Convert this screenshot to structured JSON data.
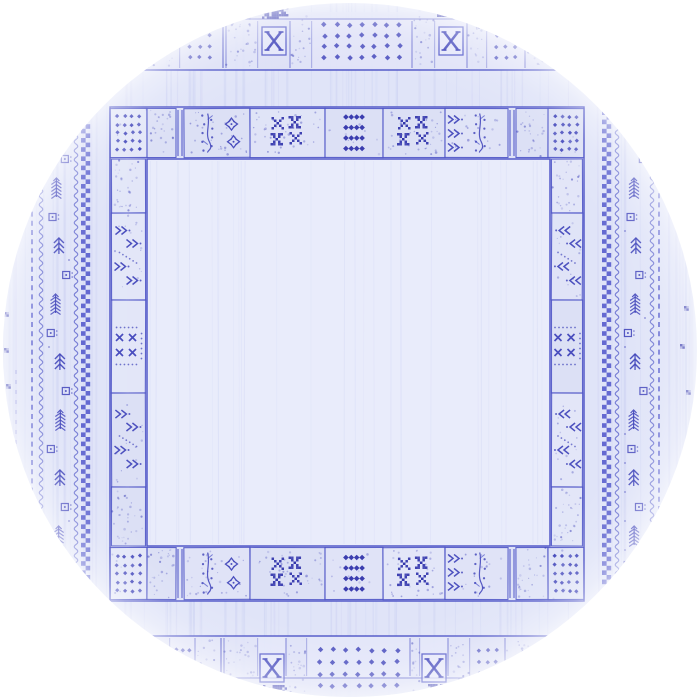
{
  "image": {
    "kind": "top-view photo of a round area rug",
    "style": "blue tribal gabbeh rug with patchwork panel borders on a pale periwinkle field",
    "page_background": "#ffffff"
  },
  "palette": {
    "base": "#e0e4f8",
    "band": "#dee2f7",
    "panel_light": "#e4e7f9",
    "panel_mid": "#e1e4f8",
    "panel_deep": "#dce0f5",
    "field": "#e9ecfb",
    "ink": "#3c40b8",
    "dark": "#3134ab",
    "line": "#4c52c6",
    "checker": "#4d54ca",
    "dash": "#5a60cf",
    "texture": "#7b86e0",
    "field_texture": "#98a2e6",
    "rim": "#ffffff"
  },
  "geometry": {
    "canvas": 700,
    "circle": {
      "cx": 350,
      "cy": 350,
      "r": 347
    },
    "ring": {
      "outer": {
        "x": 110,
        "y": 107,
        "x2": 584,
        "y2": 601
      },
      "inner": {
        "x": 147,
        "y": 159,
        "x2": 550,
        "y2": 546
      }
    },
    "outer_band_top": {
      "bg_y": 12,
      "inner_line_y": 19,
      "edge_line_y": 70
    },
    "outer_band_bottom": {
      "bg_y2": 700,
      "inner_line_y": 678,
      "edge_line_y": 636
    }
  },
  "main_border": {
    "top_panels": [
      {
        "x": 110,
        "w": 37,
        "m": "dotsGrid"
      },
      {
        "x": 147,
        "w": 29,
        "m": "speckle"
      },
      {
        "x": 176,
        "w": 8,
        "m": "divider2"
      },
      {
        "x": 184,
        "w": 66,
        "m": "treeSnow"
      },
      {
        "x": 250,
        "w": 75,
        "m": "xxChecker"
      },
      {
        "x": 325,
        "w": 58,
        "m": "diamondColumn"
      },
      {
        "x": 383,
        "w": 62,
        "m": "xxChecker"
      },
      {
        "x": 445,
        "w": 63,
        "m": "arrowSapling"
      },
      {
        "x": 508,
        "w": 8,
        "m": "divider2"
      },
      {
        "x": 516,
        "w": 32,
        "m": "speckle"
      },
      {
        "x": 548,
        "w": 36,
        "m": "dotsGrid"
      }
    ],
    "bottom_panels": [
      {
        "x": 110,
        "w": 37,
        "m": "dotsGrid"
      },
      {
        "x": 147,
        "w": 29,
        "m": "speckle"
      },
      {
        "x": 176,
        "w": 8,
        "m": "divider2"
      },
      {
        "x": 184,
        "w": 66,
        "m": "treeSnow"
      },
      {
        "x": 250,
        "w": 75,
        "m": "xxChecker"
      },
      {
        "x": 325,
        "w": 58,
        "m": "diamondColumn"
      },
      {
        "x": 383,
        "w": 62,
        "m": "xxChecker"
      },
      {
        "x": 445,
        "w": 63,
        "m": "arrowSapling"
      },
      {
        "x": 508,
        "w": 8,
        "m": "divider2"
      },
      {
        "x": 516,
        "w": 32,
        "m": "speckle"
      },
      {
        "x": 548,
        "w": 36,
        "m": "dotsGrid"
      }
    ],
    "left_panels": [
      {
        "y": 159,
        "h": 54,
        "m": "speckle"
      },
      {
        "y": 213,
        "h": 87,
        "m": "arrows_r"
      },
      {
        "y": 300,
        "h": 93,
        "m": "xxSmall"
      },
      {
        "y": 393,
        "h": 94,
        "m": "arrows_r"
      },
      {
        "y": 487,
        "h": 59,
        "m": "speckle"
      }
    ],
    "right_panels": [
      {
        "y": 159,
        "h": 54,
        "m": "speckle"
      },
      {
        "y": 213,
        "h": 87,
        "m": "arrows_l"
      },
      {
        "y": 300,
        "h": 93,
        "m": "xxSmall"
      },
      {
        "y": 393,
        "h": 94,
        "m": "arrows_l"
      },
      {
        "y": 487,
        "h": 59,
        "m": "speckle"
      }
    ]
  },
  "outer_border": {
    "top_panels": [
      {
        "x": 148,
        "w": 32,
        "m": "speckle"
      },
      {
        "x": 180,
        "w": 40,
        "m": "dotsSmall"
      },
      {
        "x": 220,
        "w": 6,
        "m": "divider"
      },
      {
        "x": 226,
        "w": 32,
        "m": "speckle"
      },
      {
        "x": 258,
        "w": 32,
        "m": "xBox"
      },
      {
        "x": 290,
        "w": 22,
        "m": "speckle"
      },
      {
        "x": 312,
        "w": 100,
        "m": "dotsWide"
      },
      {
        "x": 412,
        "w": 23,
        "m": "speckle"
      },
      {
        "x": 435,
        "w": 32,
        "m": "xBox"
      },
      {
        "x": 467,
        "w": 20,
        "m": "speckle"
      },
      {
        "x": 487,
        "w": 38,
        "m": "dotsSmall"
      },
      {
        "x": 525,
        "w": 28,
        "m": "speckle"
      }
    ],
    "bottom_panels": [
      {
        "x": 150,
        "w": 20,
        "m": "speckle"
      },
      {
        "x": 170,
        "w": 25,
        "m": "dotsSmall"
      },
      {
        "x": 195,
        "w": 23,
        "m": "speckle"
      },
      {
        "x": 218,
        "w": 6,
        "m": "divider"
      },
      {
        "x": 224,
        "w": 34,
        "m": "speckle"
      },
      {
        "x": 258,
        "w": 28,
        "m": "xBox"
      },
      {
        "x": 286,
        "w": 21,
        "m": "speckle"
      },
      {
        "x": 307,
        "w": 103,
        "m": "dotsWide"
      },
      {
        "x": 410,
        "w": 10,
        "m": "speckle"
      },
      {
        "x": 420,
        "w": 28,
        "m": "xBox"
      },
      {
        "x": 448,
        "w": 22,
        "m": "speckle"
      },
      {
        "x": 470,
        "w": 35,
        "m": "dotsSmall"
      },
      {
        "x": 505,
        "w": 45,
        "m": "speckle"
      }
    ],
    "top_blotches": [
      [
        262,
        2,
        26,
        16
      ],
      [
        437,
        5,
        19,
        12
      ]
    ],
    "bottom_blotches": [
      [
        263,
        685,
        23,
        10
      ],
      [
        428,
        684,
        18,
        9
      ]
    ]
  },
  "side_bands": {
    "left": {
      "dash_x": 32,
      "faint_dash": {
        "x": 16,
        "y1": 370,
        "y2": 520
      },
      "vines": [
        41,
        76
      ],
      "tree_center_x": 59,
      "checker_x": 81,
      "margin_glyphs": [
        [
          4,
          312
        ],
        [
          4,
          348
        ],
        [
          6,
          384
        ]
      ]
    },
    "right": {
      "dash_x": 659,
      "faint_dash": null,
      "vines": [
        617,
        652
      ],
      "tree_center_x": 635,
      "checker_x": 602,
      "margin_glyphs": [
        [
          684,
          306
        ],
        [
          680,
          344
        ],
        [
          686,
          390
        ]
      ]
    }
  },
  "motifs_legend": {
    "dotsGrid": "corner grid of diamond dots",
    "dotsSmall": "small grid of diamond dots",
    "dotsWide": "wide grid of diamond dots",
    "xBox": "serifed X inside a box",
    "xxChecker": "cluster of four pixelated X blocks",
    "xxSmall": "four small x crosses with dotted frame",
    "diamondColumn": "four rows of tight solid diamonds",
    "treeSnow": "dotted sapling with snowflake crosses",
    "arrowSapling": "arrow stack beside dotted sapling",
    "arrows_r": "double-chevron arrows pointing right with dots",
    "arrows_l": "double-chevron arrows pointing left with dots",
    "speckle": "plain speckled panel",
    "divider": "single divider line",
    "divider2": "double divider lines",
    "checker-band": "two-column checkerboard stripe",
    "dash-line": "dashed guard stripe",
    "vine-line": "wavy vine stripe",
    "tree-column": "column of fir trees and small squares",
    "margin-glyph": "tiny checker mark near rim",
    "blotch": "dark woven blotch at rim cut"
  }
}
